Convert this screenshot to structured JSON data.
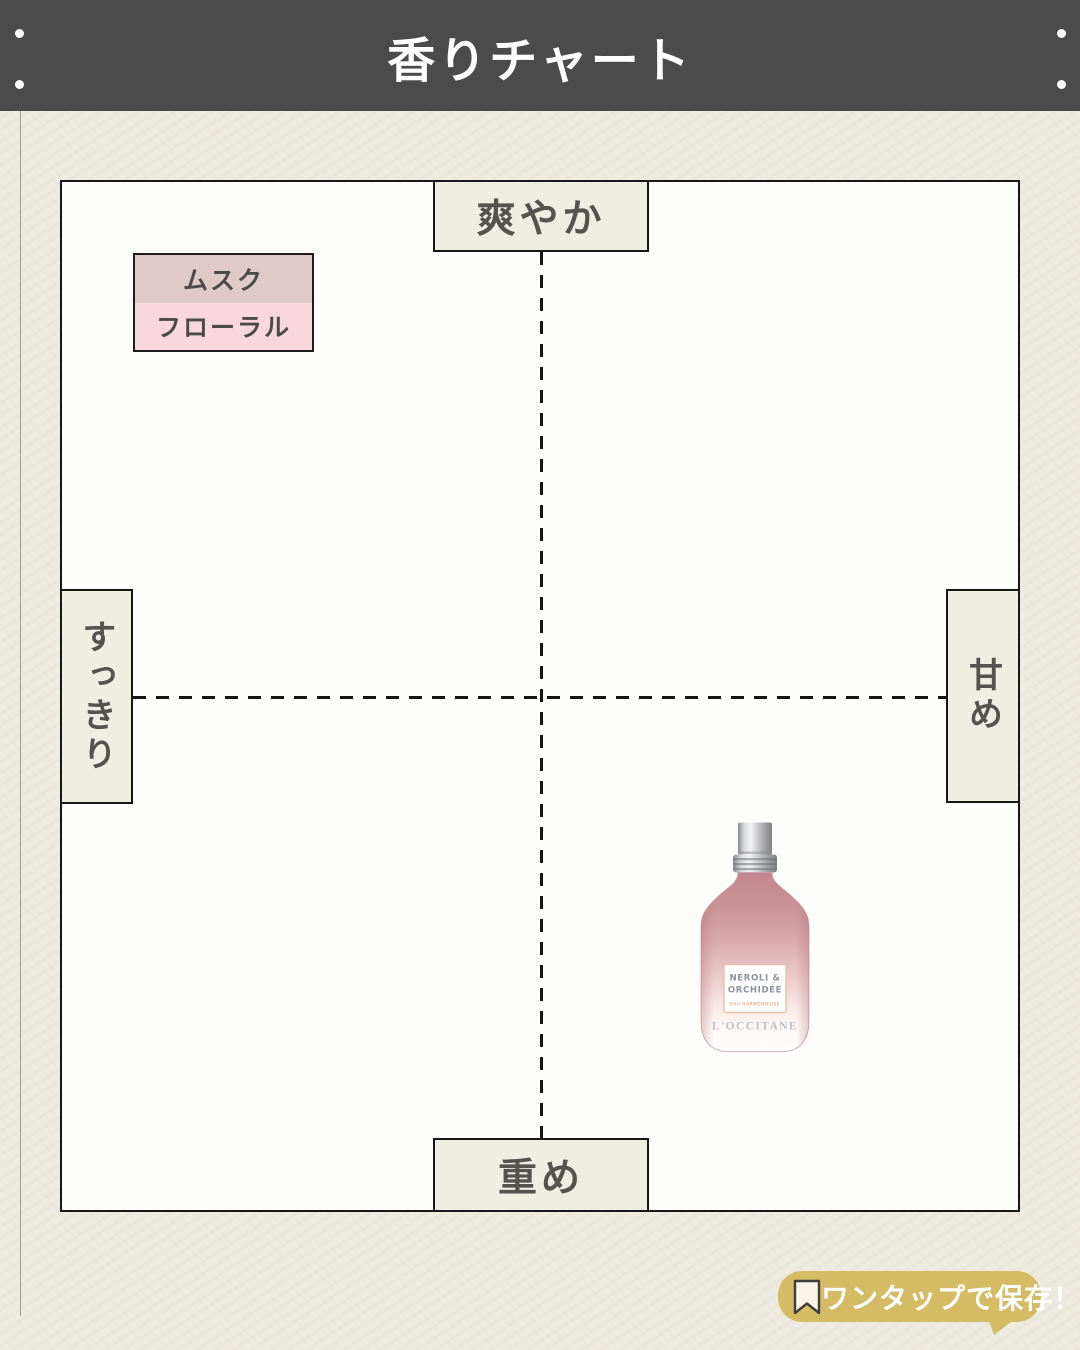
{
  "header": {
    "title": "香りチャート"
  },
  "chart_data": {
    "type": "scatter",
    "title": "香りチャート",
    "x_axis": {
      "label_negative": "すっきり",
      "label_positive": "甘め",
      "range": [
        -1,
        1
      ]
    },
    "y_axis": {
      "label_positive": "爽やか",
      "label_negative": "重め",
      "range": [
        -1,
        1
      ]
    },
    "grid": "dashed center cross",
    "legend_position": "top-left",
    "legend": [
      {
        "label": "ムスク",
        "color": "#dfc9c9"
      },
      {
        "label": "フローラル",
        "color": "#f8d8de"
      }
    ],
    "points": [
      {
        "label": "L'OCCITANE NÉROLI & ORCHIDÉE EAU HARMONIEUSE",
        "x": 0.45,
        "y": -0.47,
        "marker": "perfume-bottle-photo",
        "scent_families": [
          "ムスク",
          "フローラル"
        ]
      }
    ]
  },
  "chart": {
    "axis_labels": {
      "top": "爽やか",
      "bottom": "重め",
      "left": "すっきり",
      "right": "甘め"
    },
    "legend": {
      "items": [
        {
          "label": "ムスク",
          "color": "#dfc9c9"
        },
        {
          "label": "フローラル",
          "color": "#f8d8de"
        }
      ]
    },
    "product": {
      "brand": "L'OCCITANE",
      "name_line1": "NÉROLI &",
      "name_line2": "ORCHIDÉE",
      "subtitle": "EAU HARMONIEUSE"
    }
  },
  "badge": {
    "label": "ワンタップで保存！",
    "icon": "bookmark-icon",
    "color": "#d5bc64"
  },
  "colors": {
    "header_bg": "#4c4b4b",
    "paper_bg": "#edeae0",
    "chart_bg": "#fdfdfc",
    "axis_box_bg": "#efeee3",
    "border": "#161616",
    "text_dark": "#54534e",
    "badge_bg": "#d5bc64",
    "badge_text": "#ffffff",
    "bottle_pink": "#c98f96",
    "label_border": "#eac3a8"
  }
}
